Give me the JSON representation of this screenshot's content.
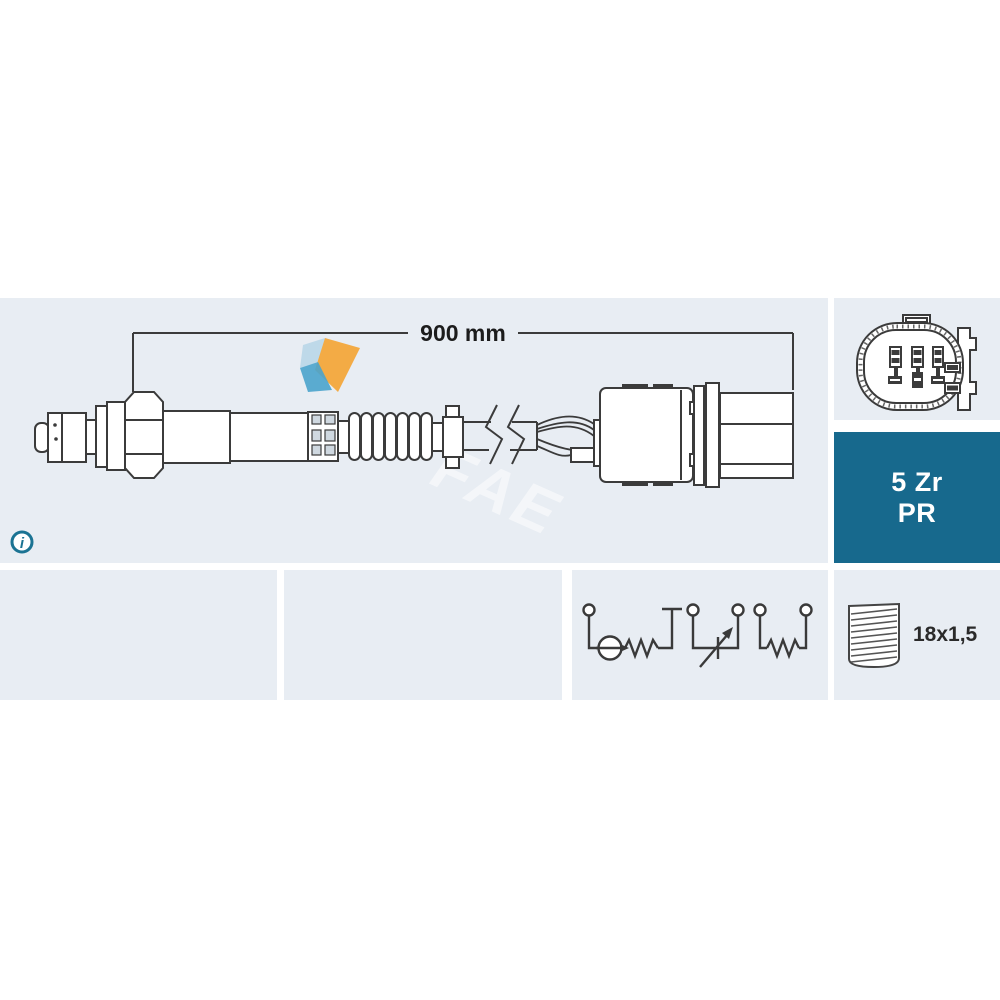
{
  "image": {
    "kind": "oxygen-lambda-sensor technical product diagram",
    "brand": "FAE"
  },
  "diagram": {
    "dimension_label": "900 mm"
  },
  "code_box": {
    "line1": "5 Zr",
    "line2": "PR"
  },
  "thread": {
    "label": "18x1,5"
  },
  "info": {
    "glyph": "i"
  },
  "watermark": {
    "text": "FAE"
  },
  "icons": {
    "info": "info-icon",
    "connector_face": "connector-face-icon",
    "wiring_schematic": "wiring-schematic-icon",
    "thread": "thread-icon",
    "cable_break": "cable-break-icon"
  },
  "colors": {
    "panel_bg": "#e8edf3",
    "code_box_bg": "#17698d",
    "code_box_text": "#ffffff",
    "line_art": "#3b3b3b",
    "teal_accent": "#1b7393",
    "label_text": "#1c1c1c",
    "logo_orange": "#f3a83b",
    "logo_blue": "#4aa3cc",
    "logo_pale_blue": "#b9d6e8"
  }
}
